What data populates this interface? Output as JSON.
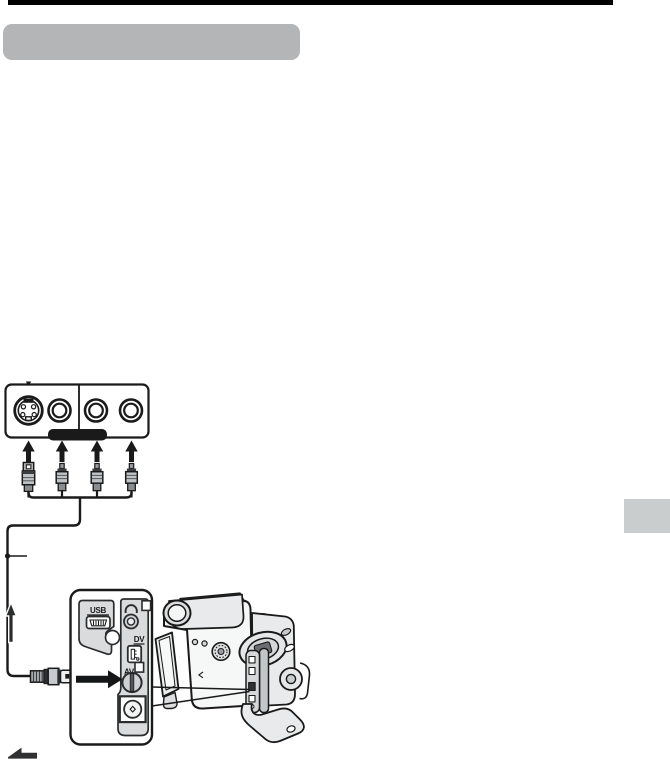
{
  "colors": {
    "page_bg": "#ffffff",
    "top_bar": "#000000",
    "heading_pill": "#b3b5b7",
    "side_tab": "#c9cdce",
    "ink": "#1a1a1a",
    "panel_gray": "#d9dbdc",
    "body_gray": "#e9eaeb",
    "plug_gray": "#c0c3c5"
  },
  "terminals": {
    "usb": "USB",
    "dv": "DV",
    "av": "AV"
  },
  "icons": {
    "s_video_jack": "s-video-jack-icon",
    "rca_jack": "rca-jack-icon",
    "headphone": "headphone-icon",
    "usb_port": "mini-usb-port-icon",
    "dv_port": "dv-port-icon",
    "av_jack": "av-jack-icon",
    "dc_in_jack": "dc-in-jack-icon",
    "flow_up": "arrow-up-icon",
    "insert": "arrow-right-icon",
    "page_continue": "arrow-left-icon"
  }
}
